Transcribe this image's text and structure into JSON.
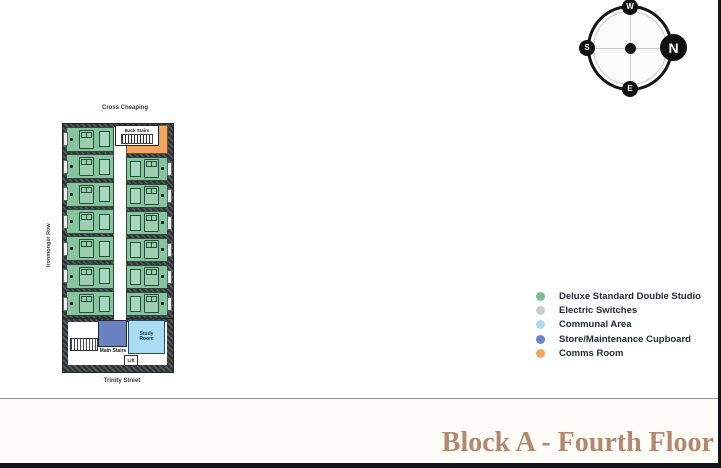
{
  "compass": {
    "n": "N",
    "e": "E",
    "s": "S",
    "w": "W"
  },
  "plan": {
    "street_top": "Cross Cheaping",
    "street_left": "Ironmonger Row",
    "street_bottom": "Trinity Street",
    "back_stairs_label": "Back Stairs",
    "main_stairs_label": "Main Stairs",
    "study_room_label": "Study Room",
    "lift_label": "Lift"
  },
  "legend": {
    "items": [
      {
        "label": "Deluxe Standard Double Studio",
        "color": "#7dbf94"
      },
      {
        "label": "Electric Switches",
        "color": "#c9ced1"
      },
      {
        "label": "Communal Area",
        "color": "#aed9f2"
      },
      {
        "label": "Store/Maintenance Cupboard",
        "color": "#6b82c4"
      },
      {
        "label": "Comms Room",
        "color": "#f2a45f"
      }
    ]
  },
  "footer": {
    "title": "Block A - Fourth Floor"
  },
  "colors": {
    "studio": "#87c39e",
    "comms": "#f2a55f",
    "store": "#6b82c1",
    "communal": "#aadcf4",
    "accent": "#b3886e"
  }
}
